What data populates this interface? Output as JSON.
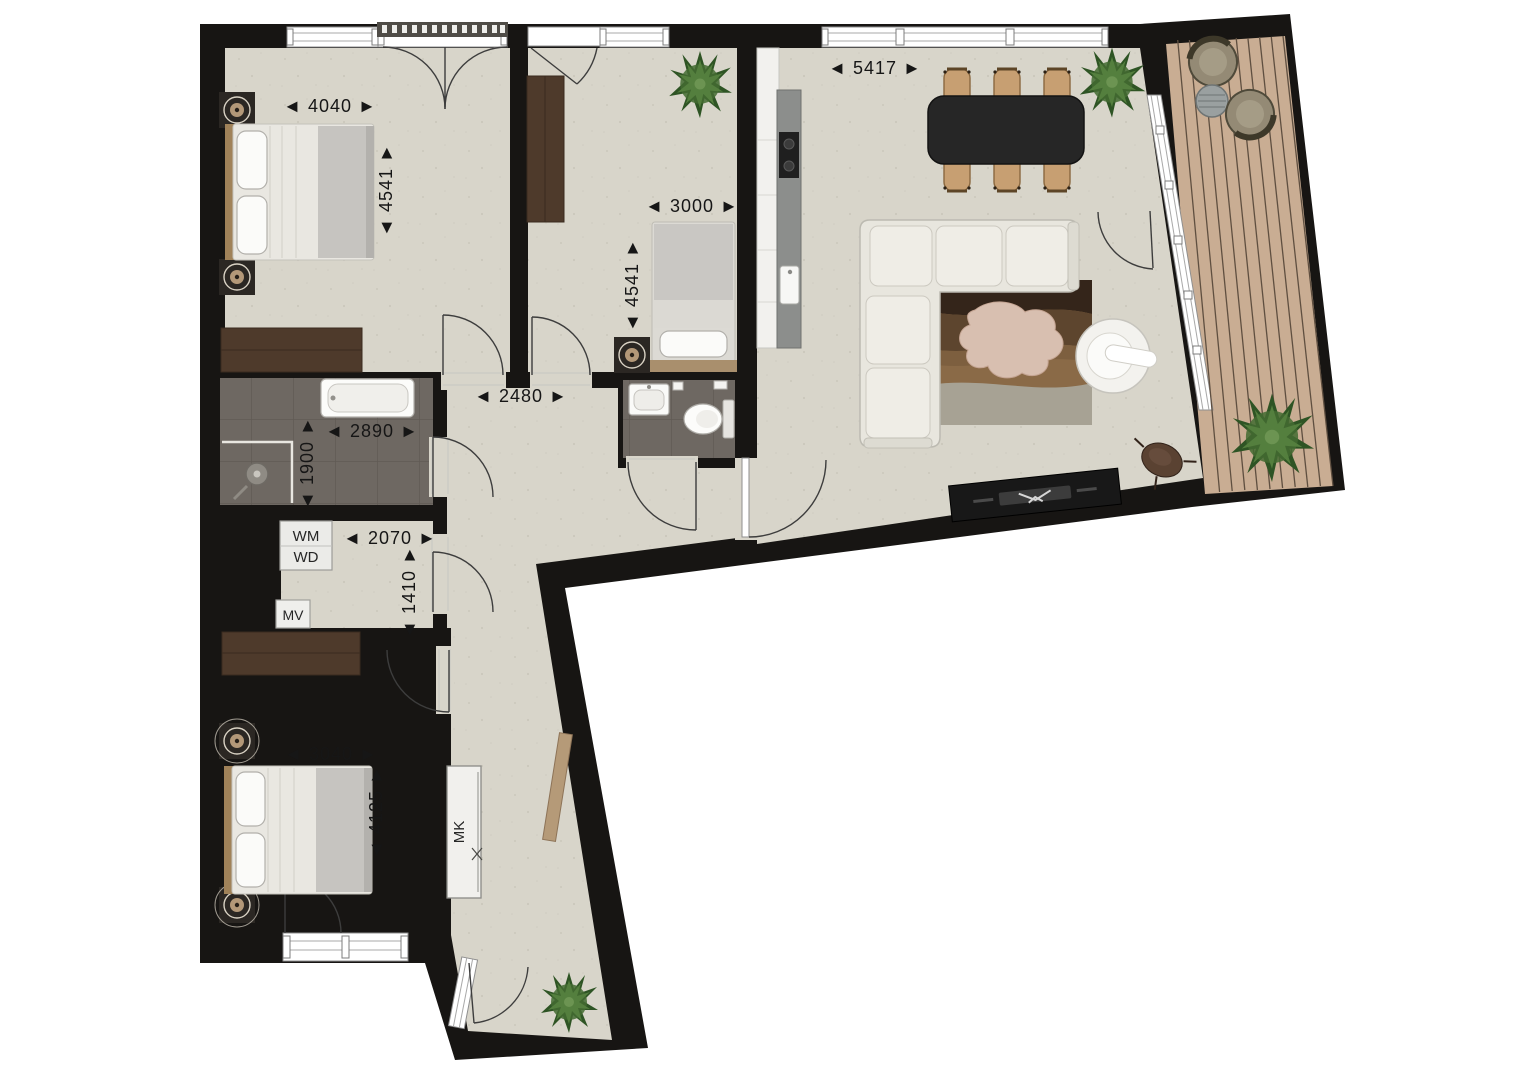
{
  "plan_type": "apartment-floor-plan",
  "rooms": {
    "bedroom_top_left": {
      "width": {
        "text": "◄ 4040 ►",
        "mm": 4040,
        "orientation": "horizontal"
      },
      "depth": {
        "text": "◄ 4541 ►",
        "mm": 4541,
        "orientation": "vertical"
      }
    },
    "bedroom_middle": {
      "width": {
        "text": "◄ 3000 ►",
        "mm": 3000,
        "orientation": "horizontal"
      },
      "depth": {
        "text": "◄ 4541 ►",
        "mm": 4541,
        "orientation": "vertical"
      }
    },
    "living_kitchen": {
      "width": {
        "text": "◄ 5417 ►",
        "mm": 5417,
        "orientation": "horizontal"
      }
    },
    "hallway": {
      "width": {
        "text": "◄ 2480 ►",
        "mm": 2480,
        "orientation": "horizontal"
      }
    },
    "bathroom": {
      "width": {
        "text": "◄ 2890 ►",
        "mm": 2890,
        "orientation": "horizontal"
      },
      "depth": {
        "text": "◄ 1900 ►",
        "mm": 1900,
        "orientation": "vertical"
      }
    },
    "utility": {
      "width": {
        "text": "◄ 2070 ►",
        "mm": 2070,
        "orientation": "horizontal"
      },
      "depth": {
        "text": "◄ 1410 ►",
        "mm": 1410,
        "orientation": "vertical"
      },
      "washer": "WM",
      "dryer": "WD",
      "vent": "MV"
    },
    "bedroom_bottom": {
      "width": {
        "text": "◄ 3040 ►",
        "mm": 3040,
        "orientation": "horizontal"
      },
      "depth": {
        "text": "◄ 4125 ►",
        "mm": 4125,
        "orientation": "vertical"
      }
    },
    "meter_cupboard": {
      "label": "MK"
    }
  },
  "palette": {
    "wall": "#171513",
    "floor": "#d8d5ca",
    "wet_room_tile": "#6e6862",
    "deck_wood": "#c9ad93",
    "deck_line": "#5f4f40",
    "wardrobe_wood": "#4e3a2b",
    "headboard_wood": "#a08259",
    "sofa_fabric": "#e8e6de",
    "dining_table": "#262626",
    "chair_wood": "#c79f72",
    "plant_green": "#3f6a2f",
    "rug_dark": "#34251a",
    "rug_mid": "#5d452e",
    "rug_light": "#a2896a",
    "sheepskin": "#d8bfb0",
    "counter_grey": "#8c8e8c"
  }
}
